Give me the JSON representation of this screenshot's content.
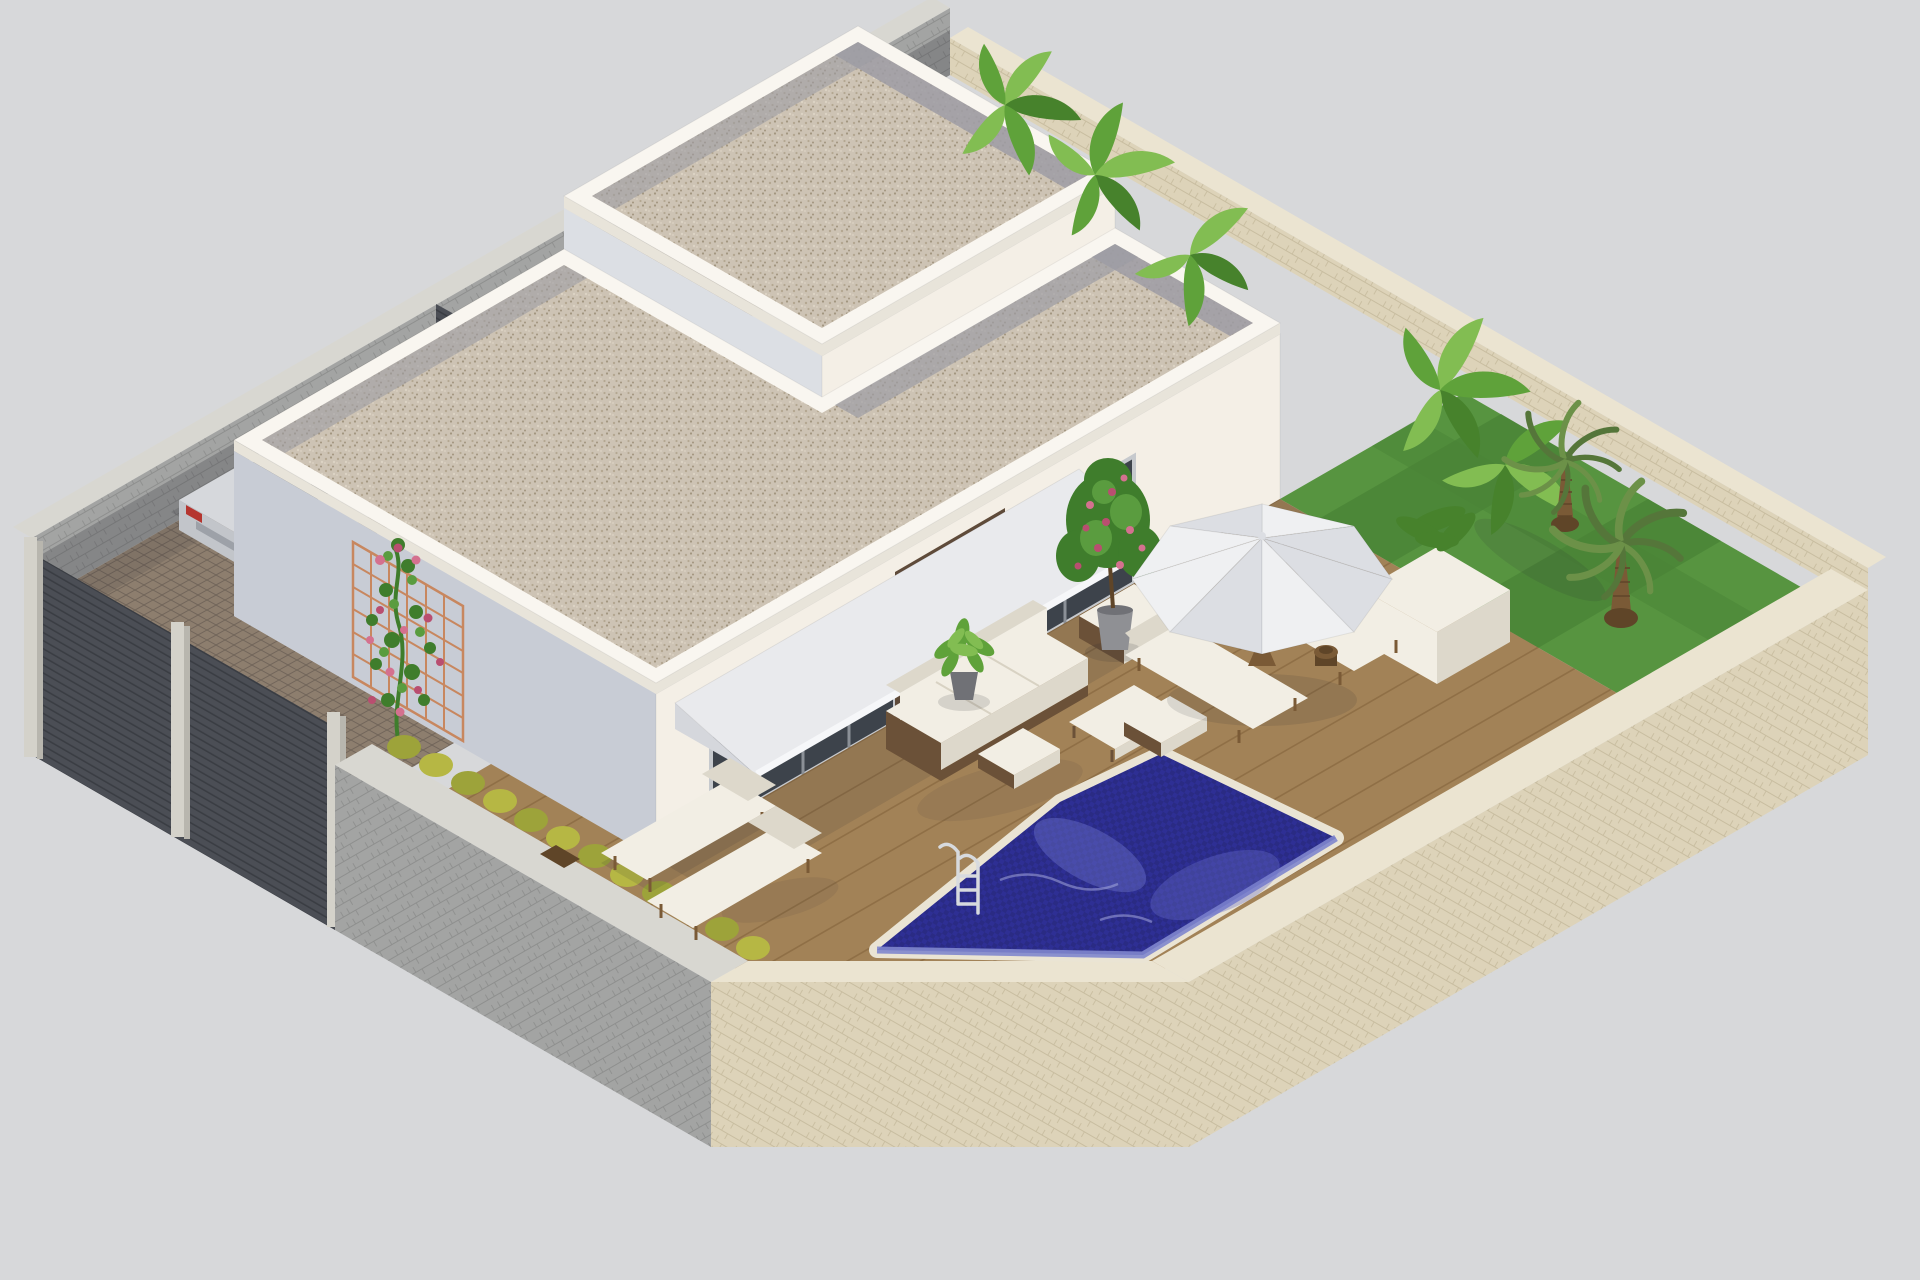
{
  "meta": {
    "kind": "3d-architectural-render",
    "projection": "isometric",
    "subject": "modern single-storey white villa on a walled plot with flat gravel roofs, wooden deck, blue mosaic pool, garden and parked SUV",
    "background": "plain light gray backdrop",
    "no_text_in_image": true
  },
  "palette": {
    "bg": "#d7d8da",
    "wall-se": "#f4efe6",
    "wall-sw": "#dcdfe4",
    "wall-shade": "#c8ccd5",
    "parapet": "#f9f6f0",
    "parapet-lip": "#e8e4da",
    "roof-gravel": "#cdc3b4",
    "gravel-dot1": "#b4a791",
    "gravel-dot2": "#a2957f",
    "gravel-dot3": "#dcd3c4",
    "roof-strip": "#9d9ca4",
    "awning-top": "#e9eaed",
    "awning-fascia": "#f6f7f9",
    "awning-side": "#d5d7dc",
    "glass": "#3d434b",
    "glass-frame": "#c6c9cd",
    "glass-mullion": "#8b9097",
    "clad": "#5f4b3a",
    "clad-line": "#48382b",
    "deck": "#a28257",
    "deck-line": "#85663d",
    "pool-coping": "#eae4d4",
    "pool-water": "#2e2f94",
    "pool-mosaic": "#262777",
    "pool-light": "#6a70c8",
    "pool-wall": "#8086cd",
    "ladder": "#d7dade",
    "grass": "#579440",
    "grass-dark": "#4a8336",
    "hedge1": "#b6b744",
    "hedge2": "#9da33a",
    "stone-beige-cap": "#ebe4d1",
    "stone-beige-face": "#ddd3b9",
    "stone-beige-line": "#c8bda0",
    "stone-gray-cap": "#d8d7d1",
    "stone-gray-face": "#a3a4a3",
    "stone-gray-line": "#8e8f8e",
    "stone-gray-dark": "#7e7e84",
    "fence": "#4b4e55",
    "fence-line": "#3a3d43",
    "pillar": "#d4d2ca",
    "pillar-side": "#b8b6ae",
    "cobble": "#8d7e6e",
    "cobble-line": "#71655a",
    "car-body": "#d6d8dc",
    "car-side": "#c2c5ca",
    "car-cabin": "#b9bdc4",
    "car-glass": "#30363e",
    "tail-red": "#b5352f",
    "tire": "#2b2d31",
    "wheel-hub": "#c8cbd0",
    "trellis": "#c8875f",
    "vine": "#3f7d2c",
    "vine-light": "#5a9c3f",
    "rose": "#d4718f",
    "rose-deep": "#b94e70",
    "foliage-light": "#82bd52",
    "foliage-mid": "#5fa23a",
    "foliage-dark": "#47822c",
    "palm-dark": "#55763a",
    "palm-mid": "#6c9148",
    "trunk": "#7a5a36",
    "trunk-dark": "#5f4528",
    "pot": "#8f9094",
    "pot-dark": "#707176",
    "furn-white": "#f2eee4",
    "furn-shade": "#ddd8cb",
    "furn-base": "#6b5138",
    "umbrella1": "#eff0f2",
    "umbrella2": "#dcdee3",
    "shadow": "#2a2a32"
  },
  "scene": {
    "plot": {
      "shape": "square plot, isometric diamond, chamfered south corner",
      "boundaries": [
        "gray stone wall north-west",
        "beige stone wall north-east",
        "beige stone wall south-east",
        "gray stone wall south-west with yellow-green hedge",
        "anthracite slat fence with stone pillars near west corner"
      ]
    },
    "house": {
      "style": "modern white cubic villa, flat gravel roofs with white parapets",
      "features": [
        "tall main block",
        "lower L-shaped front wing",
        "white sloped awning over patio",
        "dark glass sliding doors",
        "dark brown stone-clad wall sections",
        "rose trellis on west facade"
      ]
    },
    "outdoor": {
      "deck": "wooden plank terrace",
      "pool": "dark blue mosaic pool with chrome ladder",
      "furniture": [
        "white lounge sofa with dark wicker base",
        "large ottoman",
        "white coffee table",
        "two footstools",
        "two sun loungers by the pool corner",
        "two sun loungers under white parasol",
        "small round side table"
      ],
      "plants": [
        "banana plants behind the roofs",
        "two palm trees on lawn",
        "potted pink flowering shrub",
        "potted green bush",
        "white cube planter",
        "climbing rose with pink blooms",
        "yellow-green hedge row"
      ]
    },
    "vehicle": "silver SUV parked on cobblestone driveway"
  }
}
